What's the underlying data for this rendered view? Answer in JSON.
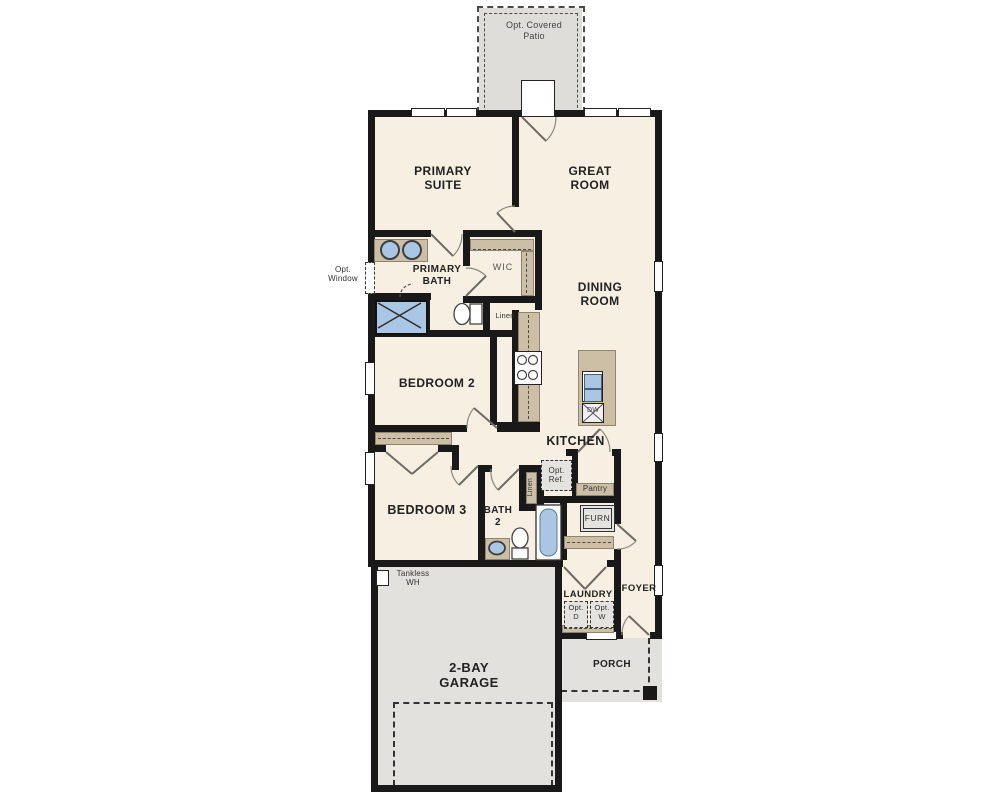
{
  "colors": {
    "floor": "#f6efe2",
    "hard_surface": "#e2e1dd",
    "counter_tan": "#cdbfa5",
    "fixture_blue": "#a9c7e5",
    "wall": "#191919",
    "text": "#222222"
  },
  "labels": {
    "patio_1": "Opt. Covered",
    "patio_2": "Patio",
    "primary_suite_1": "PRIMARY",
    "primary_suite_2": "SUITE",
    "great_room_1": "GREAT",
    "great_room_2": "ROOM",
    "opt_window_1": "Opt.",
    "opt_window_2": "Window",
    "primary_bath_1": "PRIMARY",
    "primary_bath_2": "BATH",
    "wic": "WIC",
    "linen1": "Linen",
    "dining_1": "DINING",
    "dining_2": "ROOM",
    "bedroom2": "BEDROOM 2",
    "kitchen": "KITCHEN",
    "dw": "DW",
    "opt_ref_1": "Opt.",
    "opt_ref_2": "Ref.",
    "pantry": "Pantry",
    "linen2": "Linen",
    "bedroom3": "BEDROOM 3",
    "bath2_1": "BATH",
    "bath2_2": "2",
    "furn": "FURN",
    "laundry": "LAUNDRY",
    "opt_d_1": "Opt.",
    "opt_d_2": "D",
    "opt_w_1": "Opt.",
    "opt_w_2": "W",
    "foyer": "FOYER",
    "tankless_1": "Tankless",
    "tankless_2": "WH",
    "garage_1": "2-BAY",
    "garage_2": "GARAGE",
    "porch": "PORCH"
  }
}
